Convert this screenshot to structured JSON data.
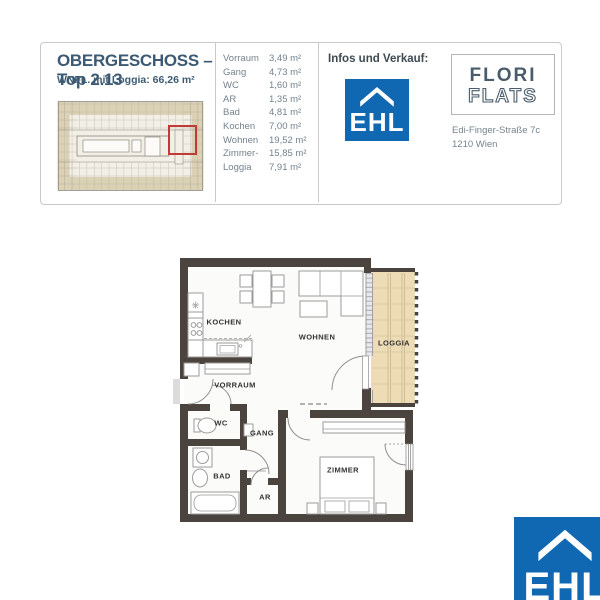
{
  "header": {
    "title": "OBERGESCHOSS – Top 2.13",
    "subtitle": "WNFL. mit Loggia: 66,26 m²",
    "room_list": [
      {
        "name": "Vorraum",
        "area": "3,49 m²"
      },
      {
        "name": "Gang",
        "area": "4,73 m²"
      },
      {
        "name": "WC",
        "area": "1,60 m²"
      },
      {
        "name": "AR",
        "area": "1,35 m²"
      },
      {
        "name": "Bad",
        "area": "4,81 m²"
      },
      {
        "name": "Kochen",
        "area": "7,00 m²"
      },
      {
        "name": "Wohnen",
        "area": "19,52 m²"
      },
      {
        "name": "Zimmer-",
        "area": "15,85 m²"
      },
      {
        "name": "Loggia",
        "area": "7,91 m²"
      }
    ],
    "contact": {
      "label": "Infos und Verkauf:",
      "ehl": "EHL",
      "project_name_line1": "FLORI",
      "project_name_line2": "FLATS",
      "address_line1": "Edi-Finger-Straße 7c",
      "address_line2": "1210 Wien"
    }
  },
  "floorplan": {
    "rooms": [
      {
        "label": "KOCHEN"
      },
      {
        "label": "WOHNEN"
      },
      {
        "label": "LOGGIA"
      },
      {
        "label": "VORRAUM"
      },
      {
        "label": "WC"
      },
      {
        "label": "GANG"
      },
      {
        "label": "BAD"
      },
      {
        "label": "AR"
      },
      {
        "label": "ZIMMER"
      }
    ]
  },
  "footer": {
    "ehl": "EHL"
  },
  "colors": {
    "ehl_blue": "#1068b2",
    "brand_slate": "#4a5c6c",
    "highlight_red": "#c23a36",
    "loggia_tan": "#eddcb5",
    "wall": "#4b443e"
  }
}
